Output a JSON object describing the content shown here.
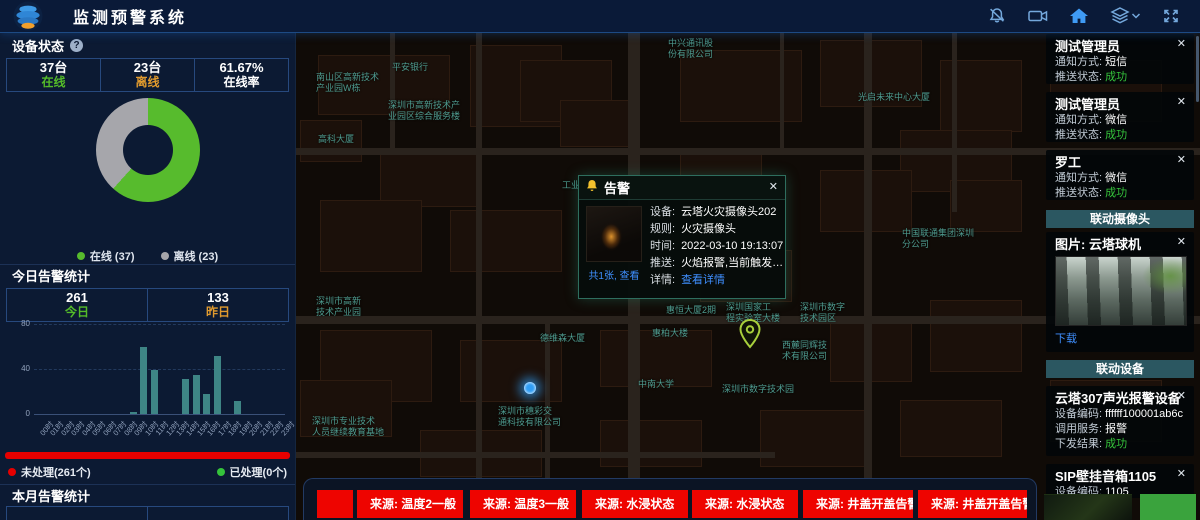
{
  "ui": {
    "close_glyph": "✕",
    "help_glyph": "?"
  },
  "header": {
    "title": "监测预警系统",
    "icons": [
      "bell-off-icon",
      "video-camera-icon",
      "home-icon",
      "layers-icon",
      "fullscreen-icon"
    ]
  },
  "device_status": {
    "title": "设备状态",
    "stats": [
      {
        "value": "37台",
        "label": "在线",
        "color": "#54bb29"
      },
      {
        "value": "23台",
        "label": "离线",
        "color": "#e09a2e"
      },
      {
        "value": "61.67%",
        "label": "在线率",
        "color": "#ffffff"
      }
    ],
    "legend": [
      {
        "label": "在线 (37)",
        "color": "#57bb2d"
      },
      {
        "label": "离线 (23)",
        "color": "#a6a6ab"
      }
    ]
  },
  "today_alarms": {
    "title": "今日告警统计",
    "stats": [
      {
        "value": "261",
        "label": "今日",
        "color": "#54bb29"
      },
      {
        "value": "133",
        "label": "昨日",
        "color": "#e09a2e"
      }
    ]
  },
  "processing_legend": {
    "unhandled": "未处理(261个)",
    "unhandled_color": "#e60000",
    "handled": "已处理(0个)",
    "handled_color": "#35c33b"
  },
  "month_alarms": {
    "title": "本月告警统计",
    "values": [
      "763",
      "1146"
    ]
  },
  "chart_data": [
    {
      "type": "pie",
      "title": "设备状态",
      "labels": [
        "在线",
        "离线"
      ],
      "values": [
        37,
        23
      ],
      "online_pct": 61.67,
      "colors": [
        "#57bb2d",
        "#a6a6ab"
      ],
      "hole": 0.52,
      "legend_position": "bottom"
    },
    {
      "type": "bar",
      "title": "今日告警统计",
      "categories": [
        "00时",
        "01时",
        "02时",
        "03时",
        "04时",
        "05时",
        "06时",
        "07时",
        "08时",
        "09时",
        "10时",
        "11时",
        "12时",
        "13时",
        "14时",
        "15时",
        "16时",
        "17时",
        "18时",
        "19时",
        "20时",
        "21时",
        "22时",
        "23时"
      ],
      "values": [
        0,
        0,
        0,
        0,
        0,
        0,
        0,
        0,
        0,
        2,
        60,
        39,
        0,
        0,
        31,
        35,
        18,
        52,
        0,
        12,
        0,
        0,
        0,
        0
      ],
      "xlabel": "",
      "ylabel": "",
      "ylim": [
        0,
        80
      ],
      "yticks": [
        0,
        40,
        80
      ],
      "bar_color": "#3e8585",
      "grid": "dashed"
    }
  ],
  "map": {
    "labels": [
      {
        "text": "中兴通讯股\n份有限公司",
        "x": 668,
        "y": 38
      },
      {
        "text": "平安银行",
        "x": 392,
        "y": 62
      },
      {
        "text": "南山区高新技术\n产业园W栋",
        "x": 316,
        "y": 72
      },
      {
        "text": "深圳市高新技术产\n业园区综合服务楼",
        "x": 388,
        "y": 100
      },
      {
        "text": "光启未来中心大厦",
        "x": 858,
        "y": 92
      },
      {
        "text": "高科大厦",
        "x": 318,
        "y": 134
      },
      {
        "text": "工业园",
        "x": 562,
        "y": 180
      },
      {
        "text": "中国联通集团深圳\n分公司",
        "x": 902,
        "y": 228
      },
      {
        "text": "深圳市高新\n技术产业园",
        "x": 316,
        "y": 296
      },
      {
        "text": "德维森大厦",
        "x": 540,
        "y": 333
      },
      {
        "text": "惠恒大厦2期",
        "x": 666,
        "y": 305
      },
      {
        "text": "惠柏大楼",
        "x": 652,
        "y": 328
      },
      {
        "text": "深圳国家工\n程实验室大楼",
        "x": 726,
        "y": 302
      },
      {
        "text": "深圳市数字\n技术园区",
        "x": 800,
        "y": 302
      },
      {
        "text": "西麓同辉技\n术有限公司",
        "x": 782,
        "y": 340
      },
      {
        "text": "中南大学",
        "x": 638,
        "y": 379
      },
      {
        "text": "深圳市数字技术园",
        "x": 722,
        "y": 384
      },
      {
        "text": "深圳市穗彩交\n通科技有限公司",
        "x": 498,
        "y": 406
      },
      {
        "text": "深圳市专业技术\n人员继续教育基地",
        "x": 312,
        "y": 416
      }
    ],
    "popup": {
      "title": "告警",
      "thumb_caption": "共1张, 查看",
      "fields": [
        {
          "label": "设备:",
          "value": "云塔火灾摄像头202"
        },
        {
          "label": "规则:",
          "value": "火灾摄像头"
        },
        {
          "label": "时间:",
          "value": "2022-03-10 19:13:07"
        },
        {
          "label": "推送:",
          "value": "火焰报警,当前触发值为..."
        },
        {
          "label": "详情:",
          "value": "查看详情",
          "link": true
        }
      ]
    }
  },
  "alert_chips": [
    "",
    "来源: 温度2一般",
    "来源: 温度3一般",
    "来源: 水浸状态",
    "来源: 水浸状态",
    "来源: 井盖开盖告警",
    "来源: 井盖开盖告警"
  ],
  "notifications": [
    {
      "name": "测试管理员",
      "fields": [
        {
          "label": "通知方式: ",
          "value": "短信"
        },
        {
          "label": "推送状态: ",
          "value": "成功",
          "success": true
        }
      ]
    },
    {
      "name": "测试管理员",
      "fields": [
        {
          "label": "通知方式: ",
          "value": "微信"
        },
        {
          "label": "推送状态: ",
          "value": "成功",
          "success": true
        }
      ]
    },
    {
      "name": "罗工",
      "fields": [
        {
          "label": "通知方式: ",
          "value": "微信"
        },
        {
          "label": "推送状态: ",
          "value": "成功",
          "success": true
        }
      ]
    }
  ],
  "linkage_camera": {
    "header": "联动摄像头",
    "card_title": "图片: 云塔球机",
    "download_label": "下载"
  },
  "linkage_devices": {
    "header": "联动设备",
    "cards": [
      {
        "name": "云塔307声光报警设备",
        "fields": [
          {
            "label": "设备编码: ",
            "value": "ffffff100001ab6c"
          },
          {
            "label": "调用服务: ",
            "value": "报警"
          },
          {
            "label": "下发结果: ",
            "value": "成功",
            "success": true
          }
        ]
      },
      {
        "name": "SIP壁挂音箱1105",
        "fields": [
          {
            "label": "设备编码: ",
            "value": "1105"
          }
        ]
      }
    ]
  }
}
